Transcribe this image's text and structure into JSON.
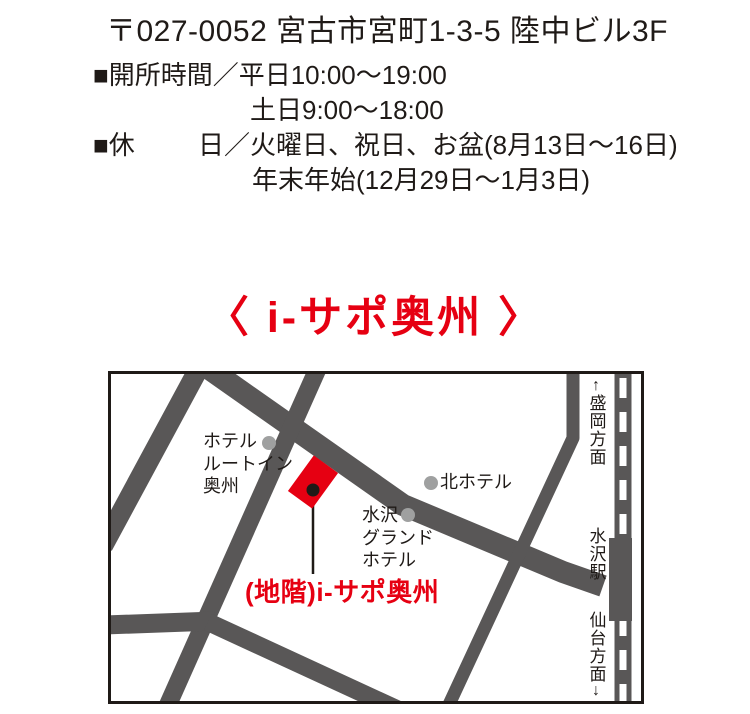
{
  "address": {
    "line": "〒027-0052 宮古市宮町1-3-5 陸中ビル3F"
  },
  "schedule": {
    "hours_line1": "■開所時間／平日10:00〜19:00",
    "hours_line2": "土日9:00〜18:00",
    "holiday_label": "■休",
    "holiday_value": "日／火曜日、祝日、お盆(8月13日〜16日)",
    "holiday_line2": "年末年始(12月29日〜1月3日)"
  },
  "heading": {
    "title": "〈 i-サポ奥州 〉"
  },
  "map": {
    "labels": {
      "hotel_routeinn": "ホテル\nルートイン\n奥州",
      "kita_hotel": "北ホテル",
      "mizusawa_grand": "水沢\nグランド\nホテル",
      "isapo_building": "(地階)i-サポ奥州",
      "morioka_direction": "盛岡方面",
      "morioka_arrow": "↑",
      "station": "水沢駅",
      "sendai_direction": "仙台方面",
      "sendai_arrow": "↓"
    },
    "colors": {
      "road_gray": "#595757",
      "marker_gray": "#9fa0a0",
      "accent_red": "#e60012",
      "ink_black": "#1f1a17"
    }
  }
}
